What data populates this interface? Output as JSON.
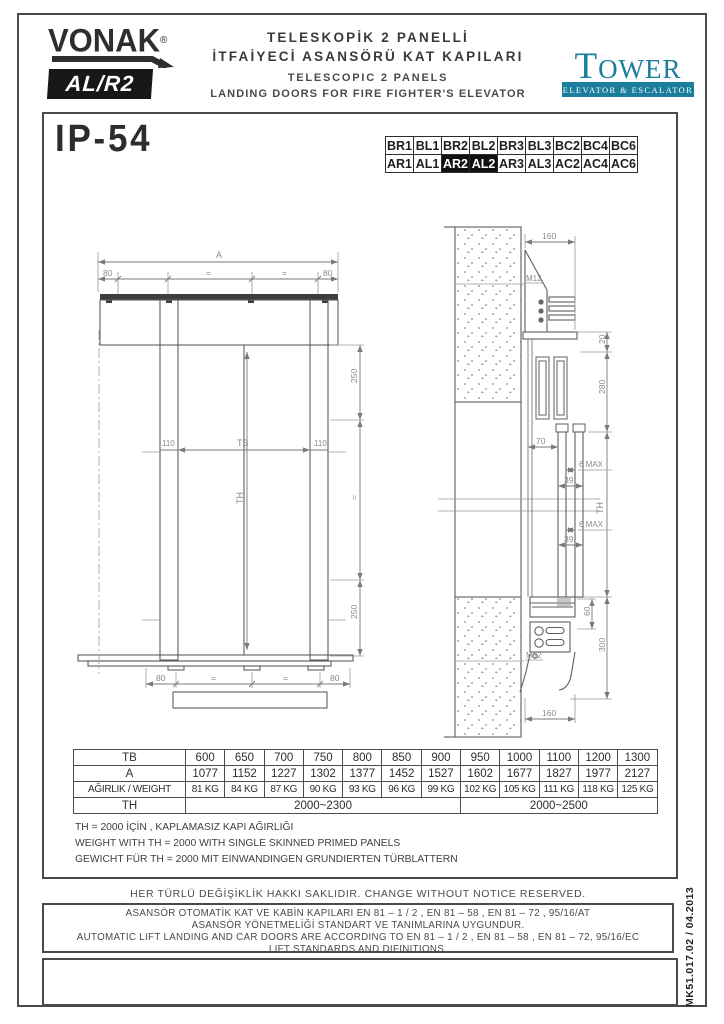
{
  "header": {
    "brand": "VONAK",
    "brand_reg": "®",
    "model": "AL/R2",
    "title_tr_line1": "TELESKOPİK 2 PANELLİ",
    "title_tr_line2": "İTFAİYECİ ASANSÖRÜ KAT KAPILARI",
    "title_en_line1": "TELESCOPIC 2 PANELS",
    "title_en_line2": "LANDING DOORS FOR FIRE FIGHTER'S ELEVATOR",
    "tower": {
      "name_first_letter": "T",
      "name_rest": "OWER",
      "tagline": "ELEVATOR & ESCALATOR",
      "color": "#1b7e9c"
    }
  },
  "protection_rating": "IP-54",
  "code_grid": {
    "rows": [
      [
        "BR1",
        "BL1",
        "BR2",
        "BL2",
        "BR3",
        "BL3",
        "BC2",
        "BC4",
        "BC6"
      ],
      [
        "AR1",
        "AL1",
        "AR2",
        "AL2",
        "AR3",
        "AL3",
        "AC2",
        "AC4",
        "AC6"
      ]
    ],
    "highlighted": [
      "AR2",
      "AL2"
    ]
  },
  "front_view": {
    "dim_a": "A",
    "dim_80": "80",
    "dim_eq": "=",
    "dim_110": "110",
    "dim_tb": "TB",
    "dim_th": "TH",
    "dim_250": "250"
  },
  "section_view": {
    "dim_160": "160",
    "label_m12": "M12",
    "dim_20": "20",
    "dim_280": "280",
    "dim_70": "70",
    "dim_6max": "6 MAX",
    "dim_39": "39",
    "dim_th": "TH",
    "dim_60": "60",
    "dim_300": "300"
  },
  "table": {
    "rows": [
      {
        "header": "TB",
        "cells": [
          "600",
          "650",
          "700",
          "750",
          "800",
          "850",
          "900",
          "950",
          "1000",
          "1100",
          "1200",
          "1300"
        ]
      },
      {
        "header": "A",
        "cells": [
          "1077",
          "1152",
          "1227",
          "1302",
          "1377",
          "1452",
          "1527",
          "1602",
          "1677",
          "1827",
          "1977",
          "2127"
        ]
      },
      {
        "header": "AĞIRLIK  /  WEIGHT",
        "small": true,
        "cells": [
          "81 KG",
          "84 KG",
          "87 KG",
          "90 KG",
          "93 KG",
          "96 KG",
          "99 KG",
          "102 KG",
          "105 KG",
          "111 KG",
          "118 KG",
          "125 KG"
        ]
      },
      {
        "header": "TH",
        "cells": [
          {
            "value": "2000~2300",
            "span": 7
          },
          {
            "value": "2000~2500",
            "span": 5
          }
        ]
      }
    ]
  },
  "notes": [
    "TH = 2000 İÇİN , KAPLAMASIZ KAPI AĞIRLIĞI",
    "WEIGHT WITH TH = 2000 WITH SINGLE SKINNED PRIMED PANELS",
    "GEWICHT FÜR TH = 2000 MIT EINWANDINGEN GRUNDIERTEN TÜRBLATTERN"
  ],
  "footer": {
    "notice": "HER TÜRLÜ DEĞİŞİKLİK HAKKI SAKLIDIR.   CHANGE WITHOUT NOTICE RESERVED.",
    "standards_lines": [
      "ASANSÖR OTOMATİK KAT VE KABİN KAPILARI EN 81 – 1 / 2 , EN 81 – 58 , EN 81 – 72 , 95/16/AT",
      "ASANSÖR YÖNETMELİĞİ STANDART VE TANIMLARINA UYGUNDUR.",
      "AUTOMATIC LIFT LANDING AND CAR DOORS ARE ACCORDING TO EN 81 – 1 / 2 , EN 81 – 58 , EN 81 – 72, 95/16/EC",
      "LIFT STANDARDS AND DIFINITIONS."
    ],
    "doc_code": "MK51.017.02 / 04.2013"
  }
}
